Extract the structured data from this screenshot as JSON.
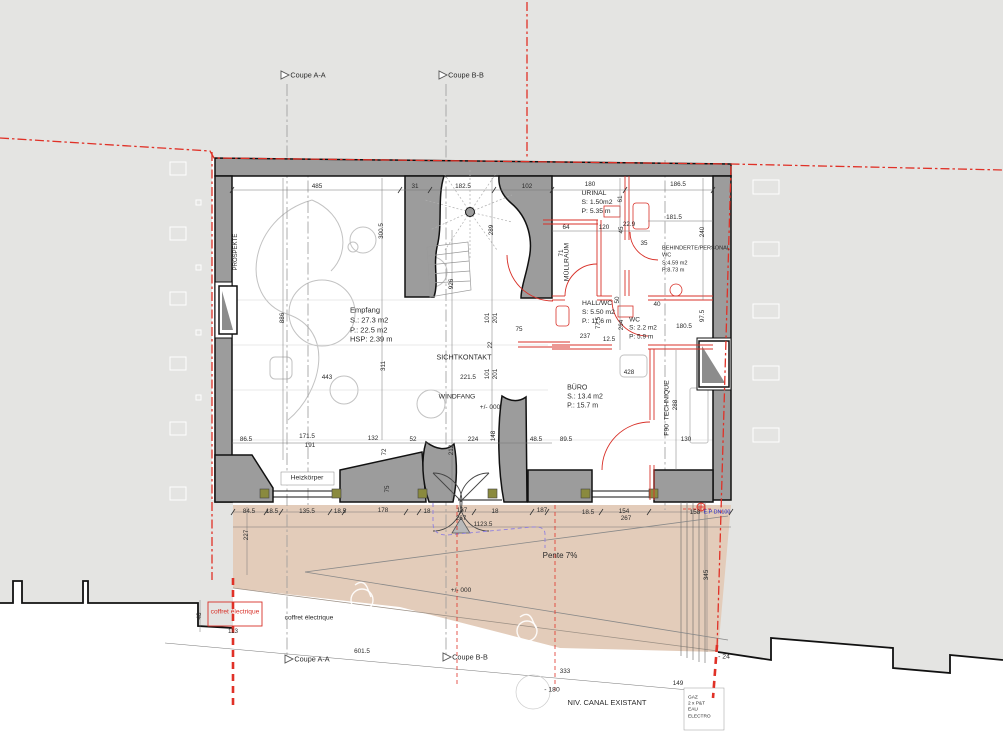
{
  "drawing": {
    "kind": "floor-plan",
    "language": "German/French"
  },
  "colors": {
    "neighbor_gray": "#e4e4e2",
    "wall_poche": "#9c9c9c",
    "wall_outline": "#111111",
    "forecourt_beige": "#e3ccba",
    "property_line_red": "#e03127",
    "new_wall_red": "#d83028",
    "canopy_violet": "#8f7fe0",
    "utility_blue": "#2a2ac8",
    "window_fix_olive": "#8a8a3e"
  },
  "rooms": [
    {
      "name": "room-label-empfang",
      "text": "Empfang\nS.: 27.3 m2\nP.: 22.5 m2\nHSP: 2.39 m",
      "x": 350,
      "y": 325,
      "size": 7.5,
      "align": "left"
    },
    {
      "name": "room-label-urinal",
      "text": "URINAL\nS: 1.50m2\nP: 5.35 m",
      "x": 597,
      "y": 203,
      "size": 6.8
    },
    {
      "name": "room-label-muellraum",
      "text": "MÜLLRAUM",
      "x": 568,
      "y": 262,
      "size": 6.8,
      "rot": -90
    },
    {
      "name": "room-label-behinderte-personal-wc",
      "text": "BEHINDERTE/PERSONAL\nWC\nS:4.59 m2\nP:8.73 m",
      "x": 696,
      "y": 260,
      "size": 5.6
    },
    {
      "name": "room-label-hall-wc",
      "text": "HALL/WC\nS: 5.50 m2\nP.: 11.6 m",
      "x": 582,
      "y": 313,
      "size": 6.8,
      "align": "left"
    },
    {
      "name": "room-label-wc",
      "text": "WC\nS: 2.2 m2\nP: 5.9 m",
      "x": 643,
      "y": 329,
      "size": 6.5
    },
    {
      "name": "room-label-buero",
      "text": "BÜRO\nS.: 13.4 m2\nP.: 15.7 m",
      "x": 585,
      "y": 397,
      "size": 7
    },
    {
      "name": "room-label-f90-technique",
      "text": "F90  TECHNIQUE",
      "x": 668,
      "y": 408,
      "size": 6.8,
      "rot": -90
    },
    {
      "name": "zone-label-sichtkontakt",
      "text": "SICHTKONTAKT",
      "x": 464,
      "y": 357,
      "size": 7.2
    },
    {
      "name": "zone-label-windfang",
      "text": "WINDFANG",
      "x": 457,
      "y": 398,
      "size": 6.8
    },
    {
      "name": "zone-label-prospekte",
      "text": "PROSPEKTE",
      "x": 237,
      "y": 252,
      "size": 6,
      "rot": -90
    }
  ],
  "annotations": [
    {
      "name": "label-heizkoerper",
      "text": "Heizkörper",
      "x": 307,
      "y": 479,
      "size": 6.8
    },
    {
      "name": "label-pente",
      "text": "Pente 7%",
      "x": 560,
      "y": 556,
      "size": 8
    },
    {
      "name": "label-level-entry",
      "text": "+/- 000",
      "x": 490,
      "y": 408,
      "size": 6.5
    },
    {
      "name": "label-level-court",
      "text": "+/- 000",
      "x": 461,
      "y": 591,
      "size": 6.5
    },
    {
      "name": "label-coffret-red",
      "text": "coffret électrique",
      "x": 235,
      "y": 613,
      "size": 6.6,
      "color": "#d83028"
    },
    {
      "name": "label-coffret-black",
      "text": "coffret électrique",
      "x": 309,
      "y": 619,
      "size": 6.6
    },
    {
      "name": "label-niv-canal",
      "text": "NIV. CANAL EXISTANT",
      "x": 607,
      "y": 703,
      "size": 7.5
    },
    {
      "name": "label-minus-180",
      "text": "- 180",
      "x": 552,
      "y": 691,
      "size": 6.8
    },
    {
      "name": "label-minus-24",
      "text": "- 24",
      "x": 724,
      "y": 658,
      "size": 6.8
    },
    {
      "name": "label-ep-dn100",
      "text": "E.P DN100",
      "x": 717,
      "y": 513,
      "size": 5.4,
      "color": "#2a2ac8"
    },
    {
      "name": "label-utilities-stack",
      "text": "GAZ\n2 x P&T\nEAU\nELECTRO",
      "x": 688,
      "y": 708,
      "size": 4.8,
      "align": "left"
    },
    {
      "name": "marker-coupe-aa-top",
      "text": "Coupe A-A",
      "x": 308,
      "y": 75,
      "size": 7.3
    },
    {
      "name": "marker-coupe-bb-top",
      "text": "Coupe B-B",
      "x": 466,
      "y": 75,
      "size": 7.3
    },
    {
      "name": "marker-coupe-aa-bottom",
      "text": "Coupe A-A",
      "x": 312,
      "y": 659,
      "size": 7.3
    },
    {
      "name": "marker-coupe-bb-bottom",
      "text": "Coupe B-B",
      "x": 470,
      "y": 657,
      "size": 7.3
    }
  ],
  "dimensions": [
    {
      "t": "485",
      "x": 317,
      "y": 187
    },
    {
      "t": "31",
      "x": 415,
      "y": 187
    },
    {
      "t": "182.5",
      "x": 463,
      "y": 187
    },
    {
      "t": "102",
      "x": 527,
      "y": 187
    },
    {
      "t": "180",
      "x": 590,
      "y": 185
    },
    {
      "t": "186.5",
      "x": 678,
      "y": 185
    },
    {
      "t": "64",
      "x": 566,
      "y": 228
    },
    {
      "t": "120",
      "x": 604,
      "y": 228
    },
    {
      "t": "22.9",
      "x": 629,
      "y": 225
    },
    {
      "t": "181.5",
      "x": 674,
      "y": 218
    },
    {
      "t": "35",
      "x": 644,
      "y": 244
    },
    {
      "t": "40",
      "x": 657,
      "y": 305
    },
    {
      "t": "61",
      "x": 621,
      "y": 199,
      "rot": -90
    },
    {
      "t": "45",
      "x": 622,
      "y": 230,
      "rot": -90
    },
    {
      "t": "240",
      "x": 703,
      "y": 232,
      "rot": -90
    },
    {
      "t": "71",
      "x": 562,
      "y": 253,
      "rot": -90
    },
    {
      "t": "300.5",
      "x": 382,
      "y": 231,
      "rot": -90
    },
    {
      "t": "289",
      "x": 492,
      "y": 230,
      "rot": -90
    },
    {
      "t": "926",
      "x": 452,
      "y": 284,
      "rot": -90
    },
    {
      "t": "886",
      "x": 283,
      "y": 318,
      "rot": -90
    },
    {
      "t": "50",
      "x": 618,
      "y": 300,
      "rot": -90
    },
    {
      "t": "77.5",
      "x": 599,
      "y": 323,
      "rot": -90
    },
    {
      "t": "264",
      "x": 622,
      "y": 325,
      "rot": -90
    },
    {
      "t": "97.5",
      "x": 703,
      "y": 316,
      "rot": -90
    },
    {
      "t": "101",
      "x": 488,
      "y": 318,
      "rot": -90
    },
    {
      "t": "201",
      "x": 496,
      "y": 318,
      "rot": -90
    },
    {
      "t": "22",
      "x": 491,
      "y": 345,
      "rot": -90
    },
    {
      "t": "101",
      "x": 488,
      "y": 374,
      "rot": -90
    },
    {
      "t": "201",
      "x": 496,
      "y": 374,
      "rot": -90
    },
    {
      "t": "75",
      "x": 519,
      "y": 330
    },
    {
      "t": "237",
      "x": 585,
      "y": 337
    },
    {
      "t": "12.5",
      "x": 609,
      "y": 340
    },
    {
      "t": "180.5",
      "x": 684,
      "y": 327
    },
    {
      "t": "221.5",
      "x": 468,
      "y": 378
    },
    {
      "t": "428",
      "x": 629,
      "y": 373
    },
    {
      "t": "443",
      "x": 327,
      "y": 378
    },
    {
      "t": "311",
      "x": 384,
      "y": 366,
      "rot": -90
    },
    {
      "t": "130",
      "x": 686,
      "y": 440
    },
    {
      "t": "288",
      "x": 676,
      "y": 405,
      "rot": -90
    },
    {
      "t": "86.5",
      "x": 246,
      "y": 440
    },
    {
      "t": "171.5",
      "x": 307,
      "y": 437
    },
    {
      "t": "191",
      "x": 310,
      "y": 446
    },
    {
      "t": "132",
      "x": 373,
      "y": 439
    },
    {
      "t": "52",
      "x": 413,
      "y": 440
    },
    {
      "t": "72",
      "x": 385,
      "y": 452,
      "rot": -90
    },
    {
      "t": "224",
      "x": 473,
      "y": 440
    },
    {
      "t": "148",
      "x": 494,
      "y": 436,
      "rot": -90
    },
    {
      "t": "212",
      "x": 452,
      "y": 450,
      "rot": -90
    },
    {
      "t": "48.5",
      "x": 536,
      "y": 440
    },
    {
      "t": "89.5",
      "x": 566,
      "y": 440
    },
    {
      "t": "75",
      "x": 388,
      "y": 489,
      "rot": -90
    },
    {
      "t": "84.5",
      "x": 249,
      "y": 512
    },
    {
      "t": "18.5",
      "x": 272,
      "y": 512
    },
    {
      "t": "135.5",
      "x": 307,
      "y": 512
    },
    {
      "t": "18.5",
      "x": 340,
      "y": 512
    },
    {
      "t": "178",
      "x": 383,
      "y": 511
    },
    {
      "t": "18",
      "x": 427,
      "y": 512
    },
    {
      "t": "137",
      "x": 462,
      "y": 511
    },
    {
      "t": "18",
      "x": 495,
      "y": 512
    },
    {
      "t": "187",
      "x": 542,
      "y": 511
    },
    {
      "t": "18.5",
      "x": 588,
      "y": 513
    },
    {
      "t": "154",
      "x": 624,
      "y": 512
    },
    {
      "t": "158",
      "x": 695,
      "y": 513
    },
    {
      "t": "267",
      "x": 461,
      "y": 519
    },
    {
      "t": "1123.5",
      "x": 483,
      "y": 525
    },
    {
      "t": "267",
      "x": 626,
      "y": 519
    },
    {
      "t": "227",
      "x": 247,
      "y": 535,
      "rot": -90
    },
    {
      "t": "345",
      "x": 707,
      "y": 575,
      "rot": -90
    },
    {
      "t": "48",
      "x": 200,
      "y": 616,
      "rot": -90
    },
    {
      "t": "113",
      "x": 233,
      "y": 632
    },
    {
      "t": "601.5",
      "x": 362,
      "y": 652
    },
    {
      "t": "333",
      "x": 565,
      "y": 672
    },
    {
      "t": "149",
      "x": 678,
      "y": 684
    }
  ]
}
